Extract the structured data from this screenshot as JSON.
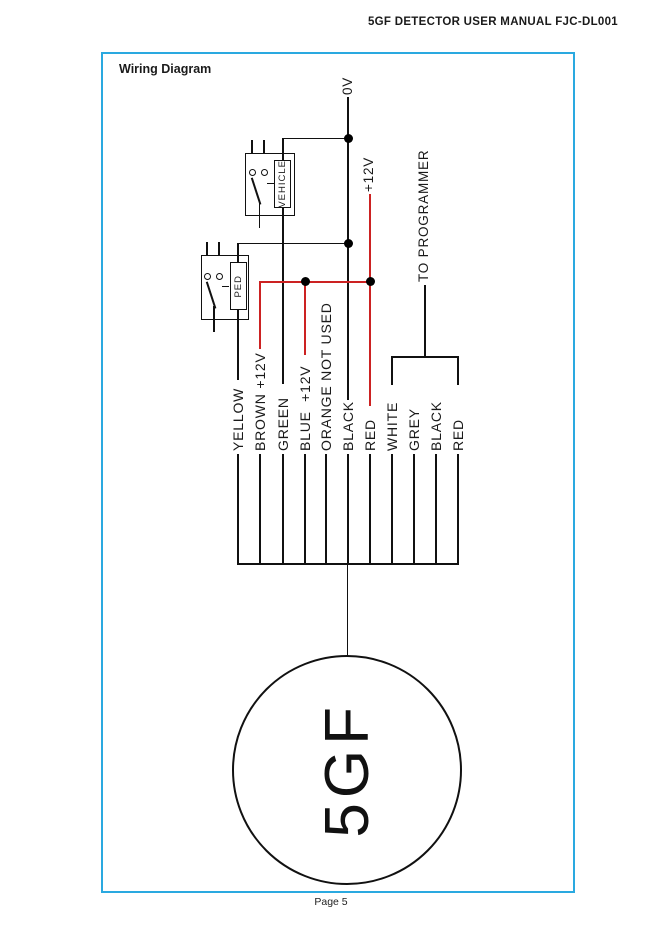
{
  "page": {
    "header": "5GF DETECTOR USER MANUAL FJC-DL001",
    "footer": "Page 5"
  },
  "diagram": {
    "title": "Wiring Diagram",
    "colors": {
      "box_border": "#2aa9e0",
      "wire_red": "#cc2222",
      "wire_black": "#111111"
    },
    "power_labels": {
      "zero_v": "0V",
      "plus_12v": "+12V"
    },
    "programmer_label": "TO PROGRAMMER",
    "relays": [
      {
        "name": "VEHICLE"
      },
      {
        "name": "PED"
      }
    ],
    "wires": [
      {
        "label": "YELLOW",
        "color": "black"
      },
      {
        "label": "BROWN +12V",
        "color": "red"
      },
      {
        "label": "GREEN",
        "color": "black"
      },
      {
        "label": "BLUE  +12V",
        "color": "red"
      },
      {
        "label": "ORANGE NOT USED",
        "color": "none"
      },
      {
        "label": "BLACK",
        "color": "black"
      },
      {
        "label": "RED",
        "color": "red"
      },
      {
        "label": "WHITE",
        "color": "black"
      },
      {
        "label": "GREY",
        "color": "black"
      },
      {
        "label": "BLACK",
        "color": "black"
      },
      {
        "label": "RED",
        "color": "black"
      }
    ],
    "device_label": "5GF"
  }
}
